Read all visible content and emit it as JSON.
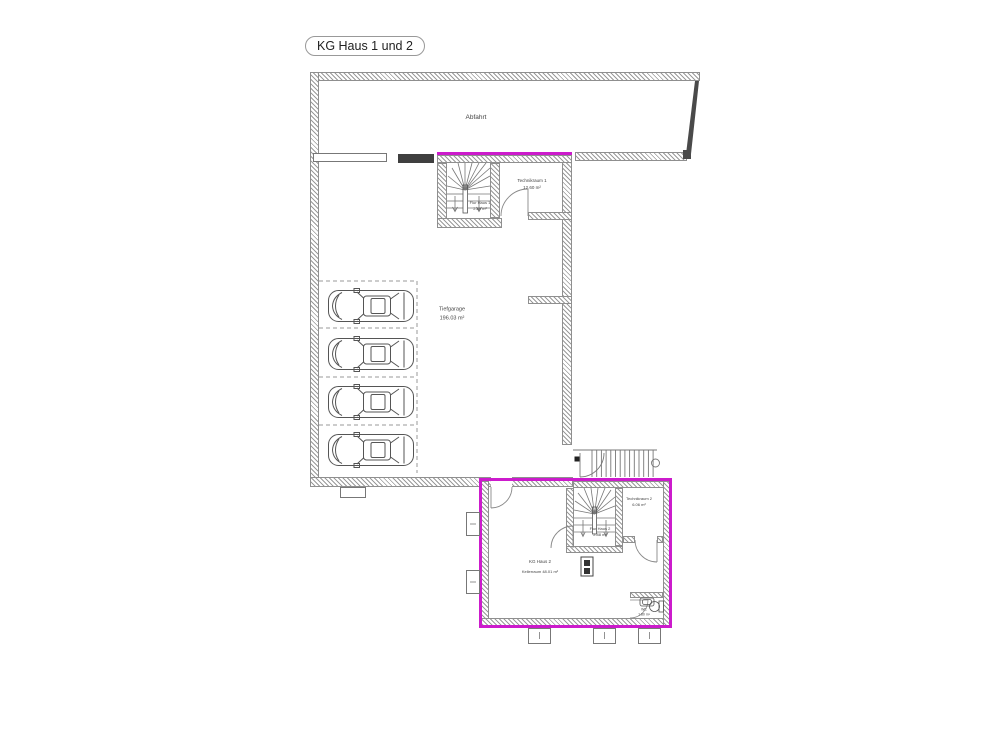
{
  "title": "KG Haus 1 und 2",
  "colors": {
    "highlight": "#cc1bcc",
    "wall_hatch": "#9a9a9a",
    "line": "#555555"
  },
  "rooms": {
    "abfahrt": {
      "name": "Abfahrt"
    },
    "tiefgarage": {
      "name": "Tiefgarage",
      "area": "196.03 m²"
    },
    "technikraum1": {
      "name": "Technikraum 1",
      "area": "12.60 m²"
    },
    "flur_haus1": {
      "name": "Flur Haus 1",
      "area": "2.89 m²"
    },
    "technikraum2": {
      "name": "Technikraum 2",
      "area": "6.06 m²"
    },
    "flur_haus2": {
      "name": "Flur Haus 2",
      "area": "2.88 m²"
    },
    "kg_haus2": {
      "name": "KG Haus 2",
      "area": "Kellerraum 48.01 m²"
    },
    "wc": {
      "name": "WC",
      "area": "1.80 m²"
    }
  },
  "counts": {
    "parking_spaces": 4
  }
}
